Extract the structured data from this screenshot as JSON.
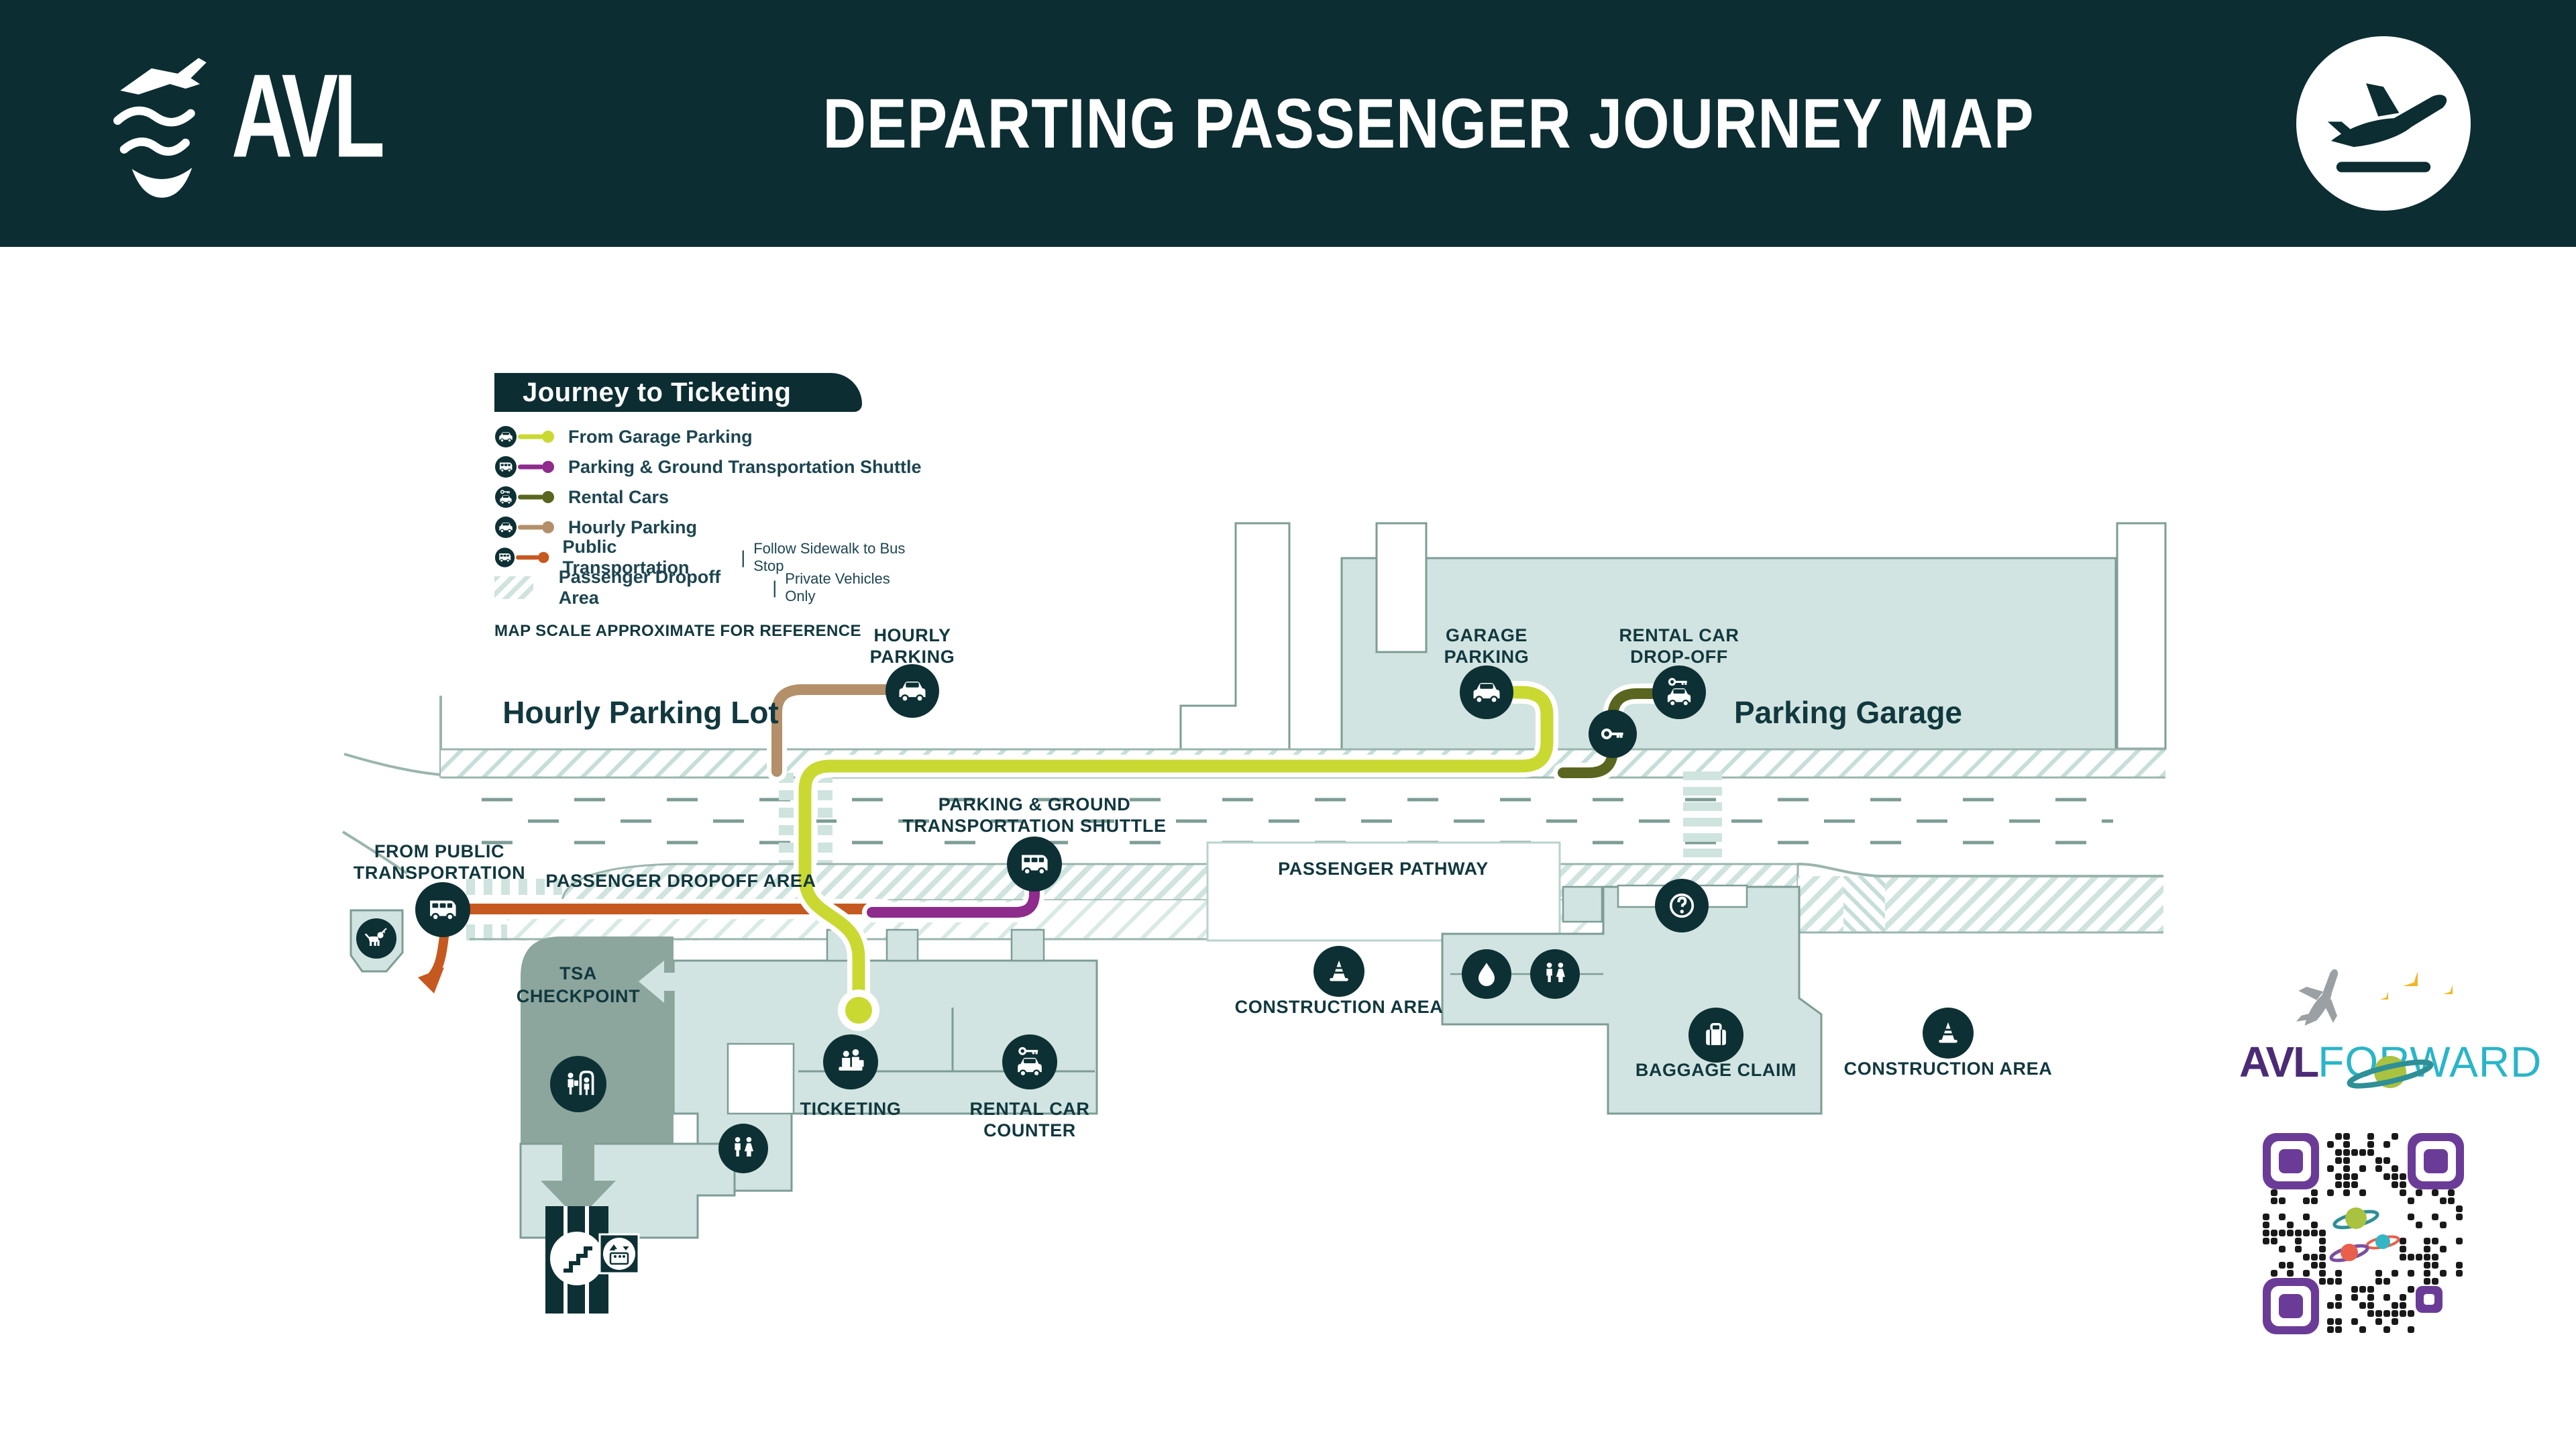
{
  "header": {
    "logo_text": "AVL",
    "title": "DEPARTING PASSENGER JOURNEY MAP"
  },
  "legend": {
    "title": "Journey to Ticketing",
    "separator": "|",
    "items": [
      {
        "icon": "car-icon",
        "label": "From Garage Parking",
        "color": "#c9d932"
      },
      {
        "icon": "shuttle-icon",
        "label": "Parking & Ground Transportation Shuttle",
        "color": "#8e2b8c"
      },
      {
        "icon": "rental-car-icon",
        "label": "Rental Cars",
        "color": "#5a661f"
      },
      {
        "icon": "car-icon",
        "label": "Hourly Parking",
        "color": "#b3906a"
      },
      {
        "icon": "bus-icon",
        "label": "Public Transportation",
        "sub": "Follow Sidewalk to Bus Stop",
        "color": "#c5591f"
      }
    ],
    "dropoff_item": {
      "label": "Passenger Dropoff Area",
      "sub": "Private Vehicles Only"
    },
    "note": "MAP SCALE APPROXIMATE FOR REFERENCE"
  },
  "map": {
    "labels": {
      "hourly_parking_lot": "Hourly Parking Lot",
      "hourly_parking": [
        "HOURLY",
        "PARKING"
      ],
      "garage_parking": [
        "GARAGE",
        "PARKING"
      ],
      "rental_car_dropoff": [
        "RENTAL CAR",
        "DROP-OFF"
      ],
      "parking_garage": "Parking Garage",
      "shuttle": [
        "PARKING & GROUND",
        "TRANSPORTATION SHUTTLE"
      ],
      "passenger_dropoff_area": "PASSENGER DROPOFF AREA",
      "passenger_pathway": "PASSENGER PATHWAY",
      "from_public_transportation": [
        "FROM PUBLIC",
        "TRANSPORTATION"
      ],
      "tsa_checkpoint": [
        "TSA",
        "CHECKPOINT"
      ],
      "ticketing": "TICKETING",
      "rental_car_counter": [
        "RENTAL CAR",
        "COUNTER"
      ],
      "construction_area_left": "CONSTRUCTION AREA",
      "construction_area_right": "CONSTRUCTION AREA",
      "baggage_claim": "BAGGAGE CLAIM"
    },
    "colors": {
      "header_bg": "#0c2d31",
      "icon_dark": "#0d3034",
      "terminal_fill": "#d2e4e1",
      "tsa_fill": "#8ca69e",
      "border": "#7d9c96",
      "route_garage": "#c9d932",
      "route_shuttle": "#8e2b8c",
      "route_rental": "#5a661f",
      "route_hourly": "#b3906a",
      "route_public": "#c5591f"
    }
  },
  "footer": {
    "brand": "AVL",
    "brand2": "FORWARD"
  }
}
